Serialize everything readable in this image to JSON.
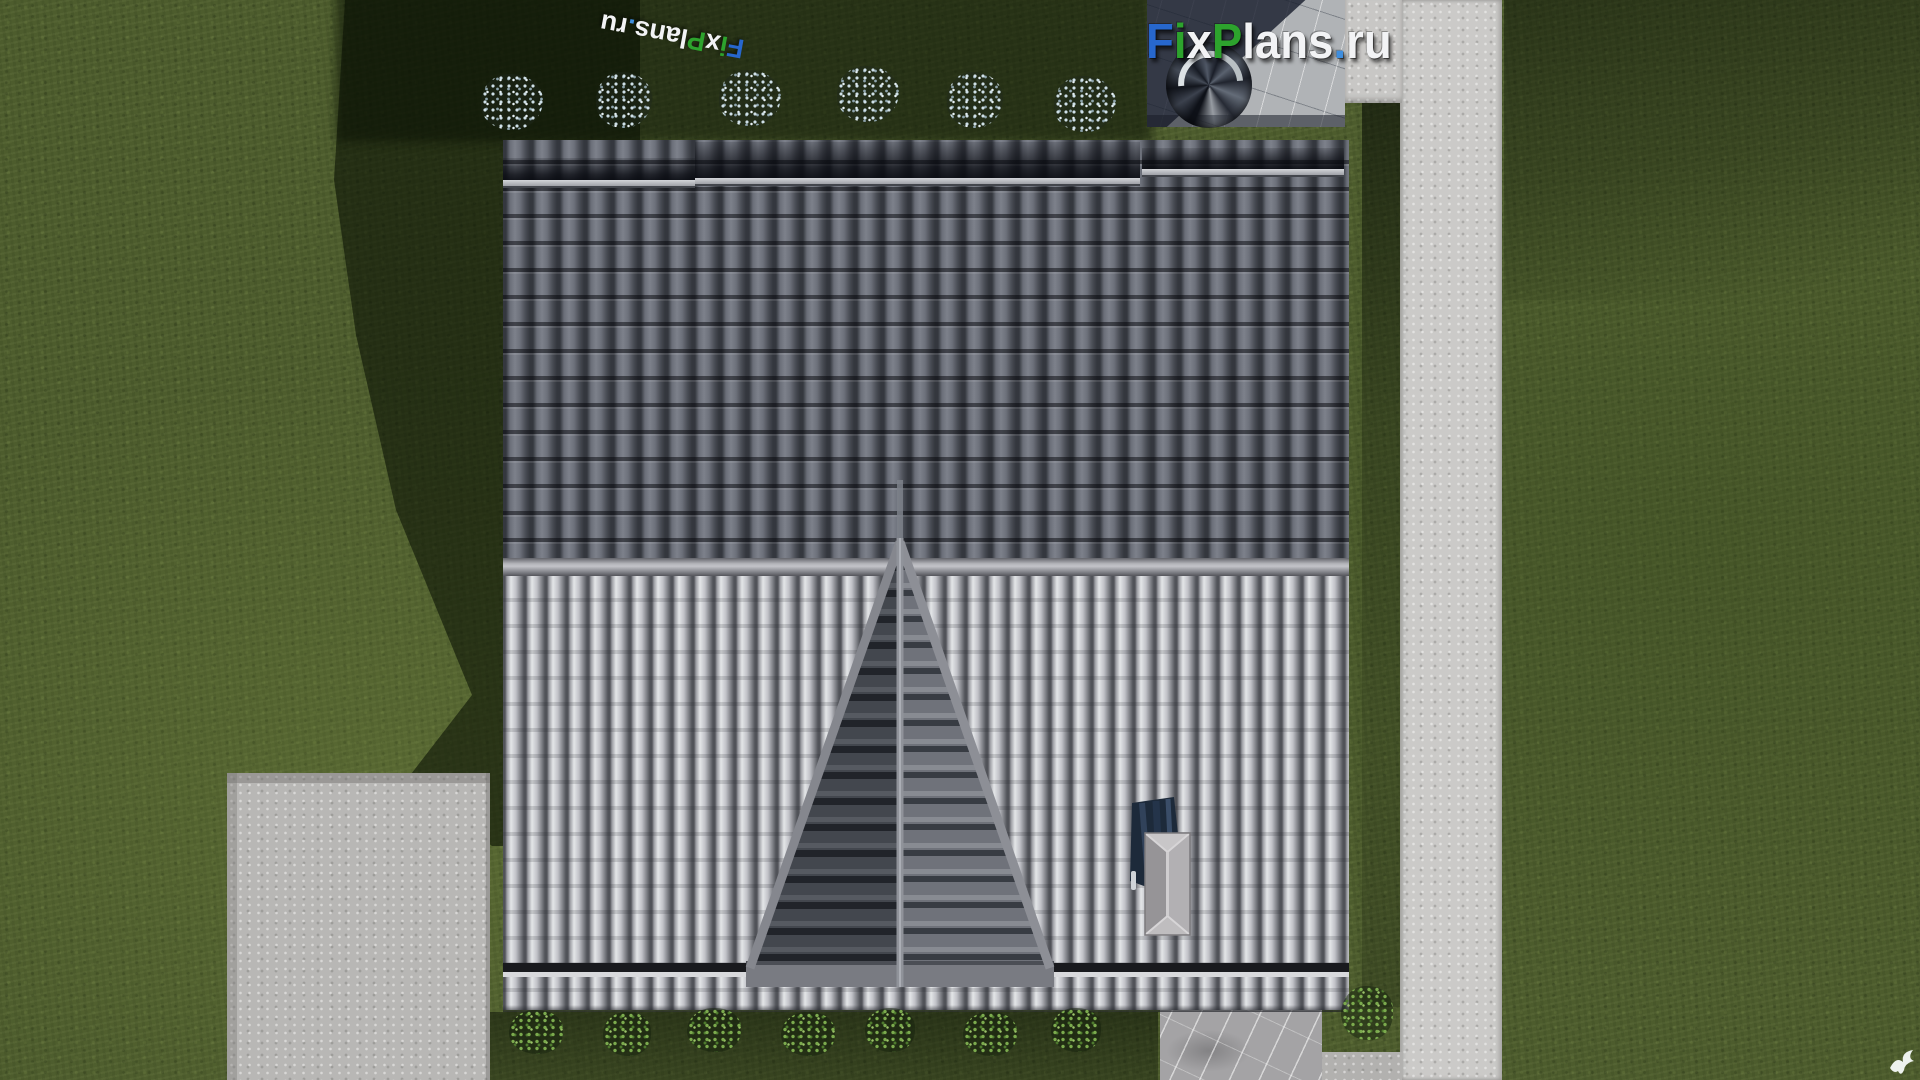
{
  "branding": {
    "site_logo_text": "FixPlans.ru",
    "watermark_text": "FixPlans.ru",
    "logo_segments": [
      {
        "text": "F",
        "color": "#2767cd"
      },
      {
        "text": "i",
        "color": "#2da32d"
      },
      {
        "text": "x",
        "color": "#f2f3f5"
      },
      {
        "text": "P",
        "color": "#2da32d"
      },
      {
        "text": "lans",
        "color": "#f2f3f5"
      },
      {
        "text": ".",
        "color": "#3f8ede"
      },
      {
        "text": "ru",
        "color": "#f2f3f5"
      }
    ]
  },
  "palette": {
    "grass": "#4d5c2d",
    "grass_shadow": "#1c2810",
    "path_concrete": "#cbcac8",
    "concrete_pad": "#b8b7b5",
    "stone_patio": "#a4a3a5",
    "patio_marble_shadow": "#181f2d",
    "roof_upper_tiles": "#575b64",
    "roof_lower_tiles": "#c0c1c7",
    "ridge_band": "#b4b5ba",
    "fascia": "#9fa0a6",
    "gable_left_face": "#43474e",
    "gable_right_face": "#6f727a",
    "chimney_flue": "#1d2a3a",
    "chimney_cap": "#b0aeb1",
    "flower_bush": "#cfe0e8",
    "green_bush": "#7cab4e",
    "bird": "#edf1ee"
  }
}
